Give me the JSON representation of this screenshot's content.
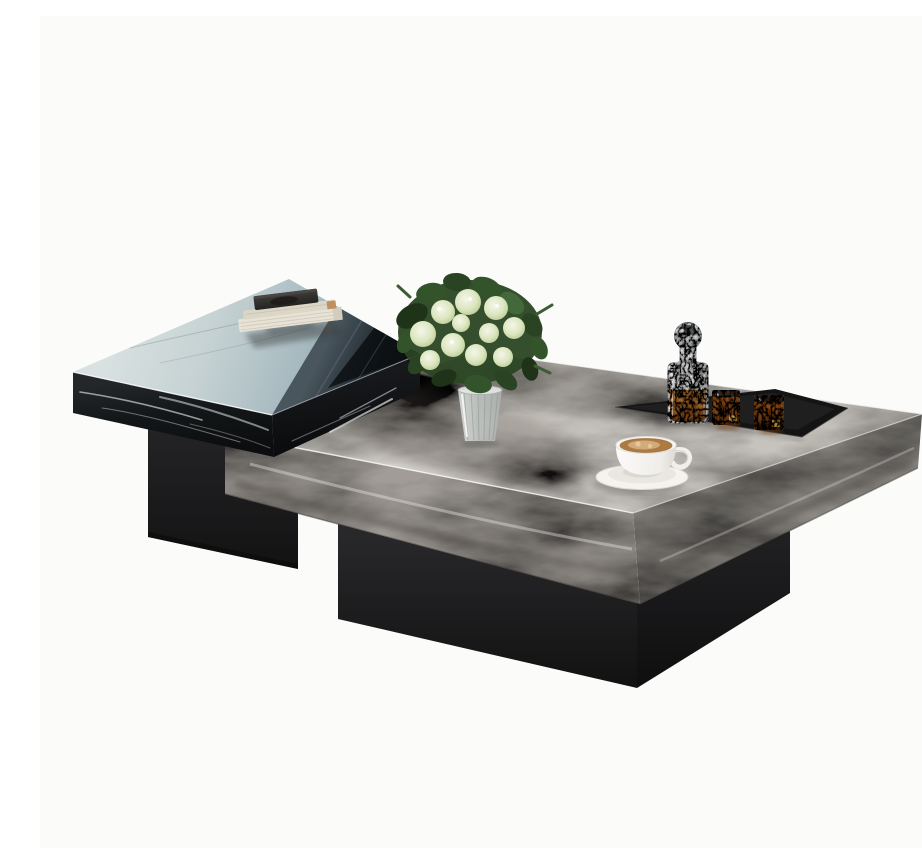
{
  "meta": {
    "title": "Nesting marble coffee table set — product photo",
    "canvas_width": 922,
    "canvas_height": 832,
    "background": "#fbfbf9"
  },
  "accessibility": {
    "alt": "Studio product photo on a white background: a small glossy black marble nesting table holding a stack of books overlaps a large grey marble coffee table. On the grey table sit a bouquet of pale green roses in a ribbed glass vase, a black tray with a crystal whiskey decanter and two amber-filled tumblers, and a white cappuccino cup on a saucer. Both tables rest on matte black plinth bases."
  },
  "palette": {
    "background": "#fbfbf9",
    "black_marble": "#17191b",
    "black_marble_dark": "#0e1012",
    "black_top_reflection_light": "#cdd8d9",
    "black_top_reflection_mid": "#aebfc3",
    "black_top_reflection_dark": "#14181b",
    "marble_vein_white": "#e8ecec",
    "plinth_black": "#1d1d1e",
    "grey_marble_top": "#c6c2bc",
    "grey_marble_left_face": "#a19c96",
    "grey_marble_right_face": "#8d8984",
    "tray_black": "#161616",
    "amber_spirit": "#8a4a16",
    "amber_light": "#c47a28",
    "cup_white": "#f7f5f2",
    "coffee_brown": "#ad7a42",
    "foam_tan": "#d9b383",
    "book_cream": "#e7e2d5",
    "book_charcoal": "#302f2c",
    "book_tan_accent": "#bd8a52",
    "leaf_green_dark": "#273f21",
    "leaf_green_mid": "#35552c",
    "rose_pale_green": "#dee8c6",
    "vase_glass": "#ccd1cf"
  },
  "scene": {
    "description": "Two-piece modern nesting coffee table set photographed on a seamless white studio background.",
    "objects": [
      {
        "id": "small-black-table",
        "label": "Small square black marble table, mirror-gloss top with sky reflection, white veined sides, matte black plinth base",
        "color": "#17191b"
      },
      {
        "id": "large-grey-table",
        "label": "Large square grey marble table, thick veined slab on matte black plinth base",
        "color": "#a19c96"
      },
      {
        "id": "book-stack",
        "label": "Stack of cream hardcover books with a charcoal book on top, reflected in the glossy black tabletop",
        "colors": [
          "#e7e2d5",
          "#302f2c",
          "#bd8a52"
        ]
      },
      {
        "id": "flower-bouquet",
        "label": "Bouquet of pale green-white roses with dark foliage in a ribbed clear glass vase",
        "colors": [
          "#dee8c6",
          "#273f21",
          "#ccd1cf"
        ]
      },
      {
        "id": "serving-tray",
        "label": "Low rectangular black serving tray set near the back edge of the grey table",
        "color": "#161616"
      },
      {
        "id": "whiskey-decanter",
        "label": "Faceted crystal decanter with round ball stopper, lower half filled with amber spirit",
        "colors": [
          "#e3e5e4",
          "#8a4a16"
        ]
      },
      {
        "id": "whiskey-glass",
        "label": "Textured crystal tumbler filled with amber spirit",
        "count": 2,
        "color": "#8a4a16"
      },
      {
        "id": "coffee-cup",
        "label": "White cappuccino cup with latte art on a matching white saucer",
        "colors": [
          "#f7f5f2",
          "#ad7a42"
        ]
      }
    ]
  }
}
